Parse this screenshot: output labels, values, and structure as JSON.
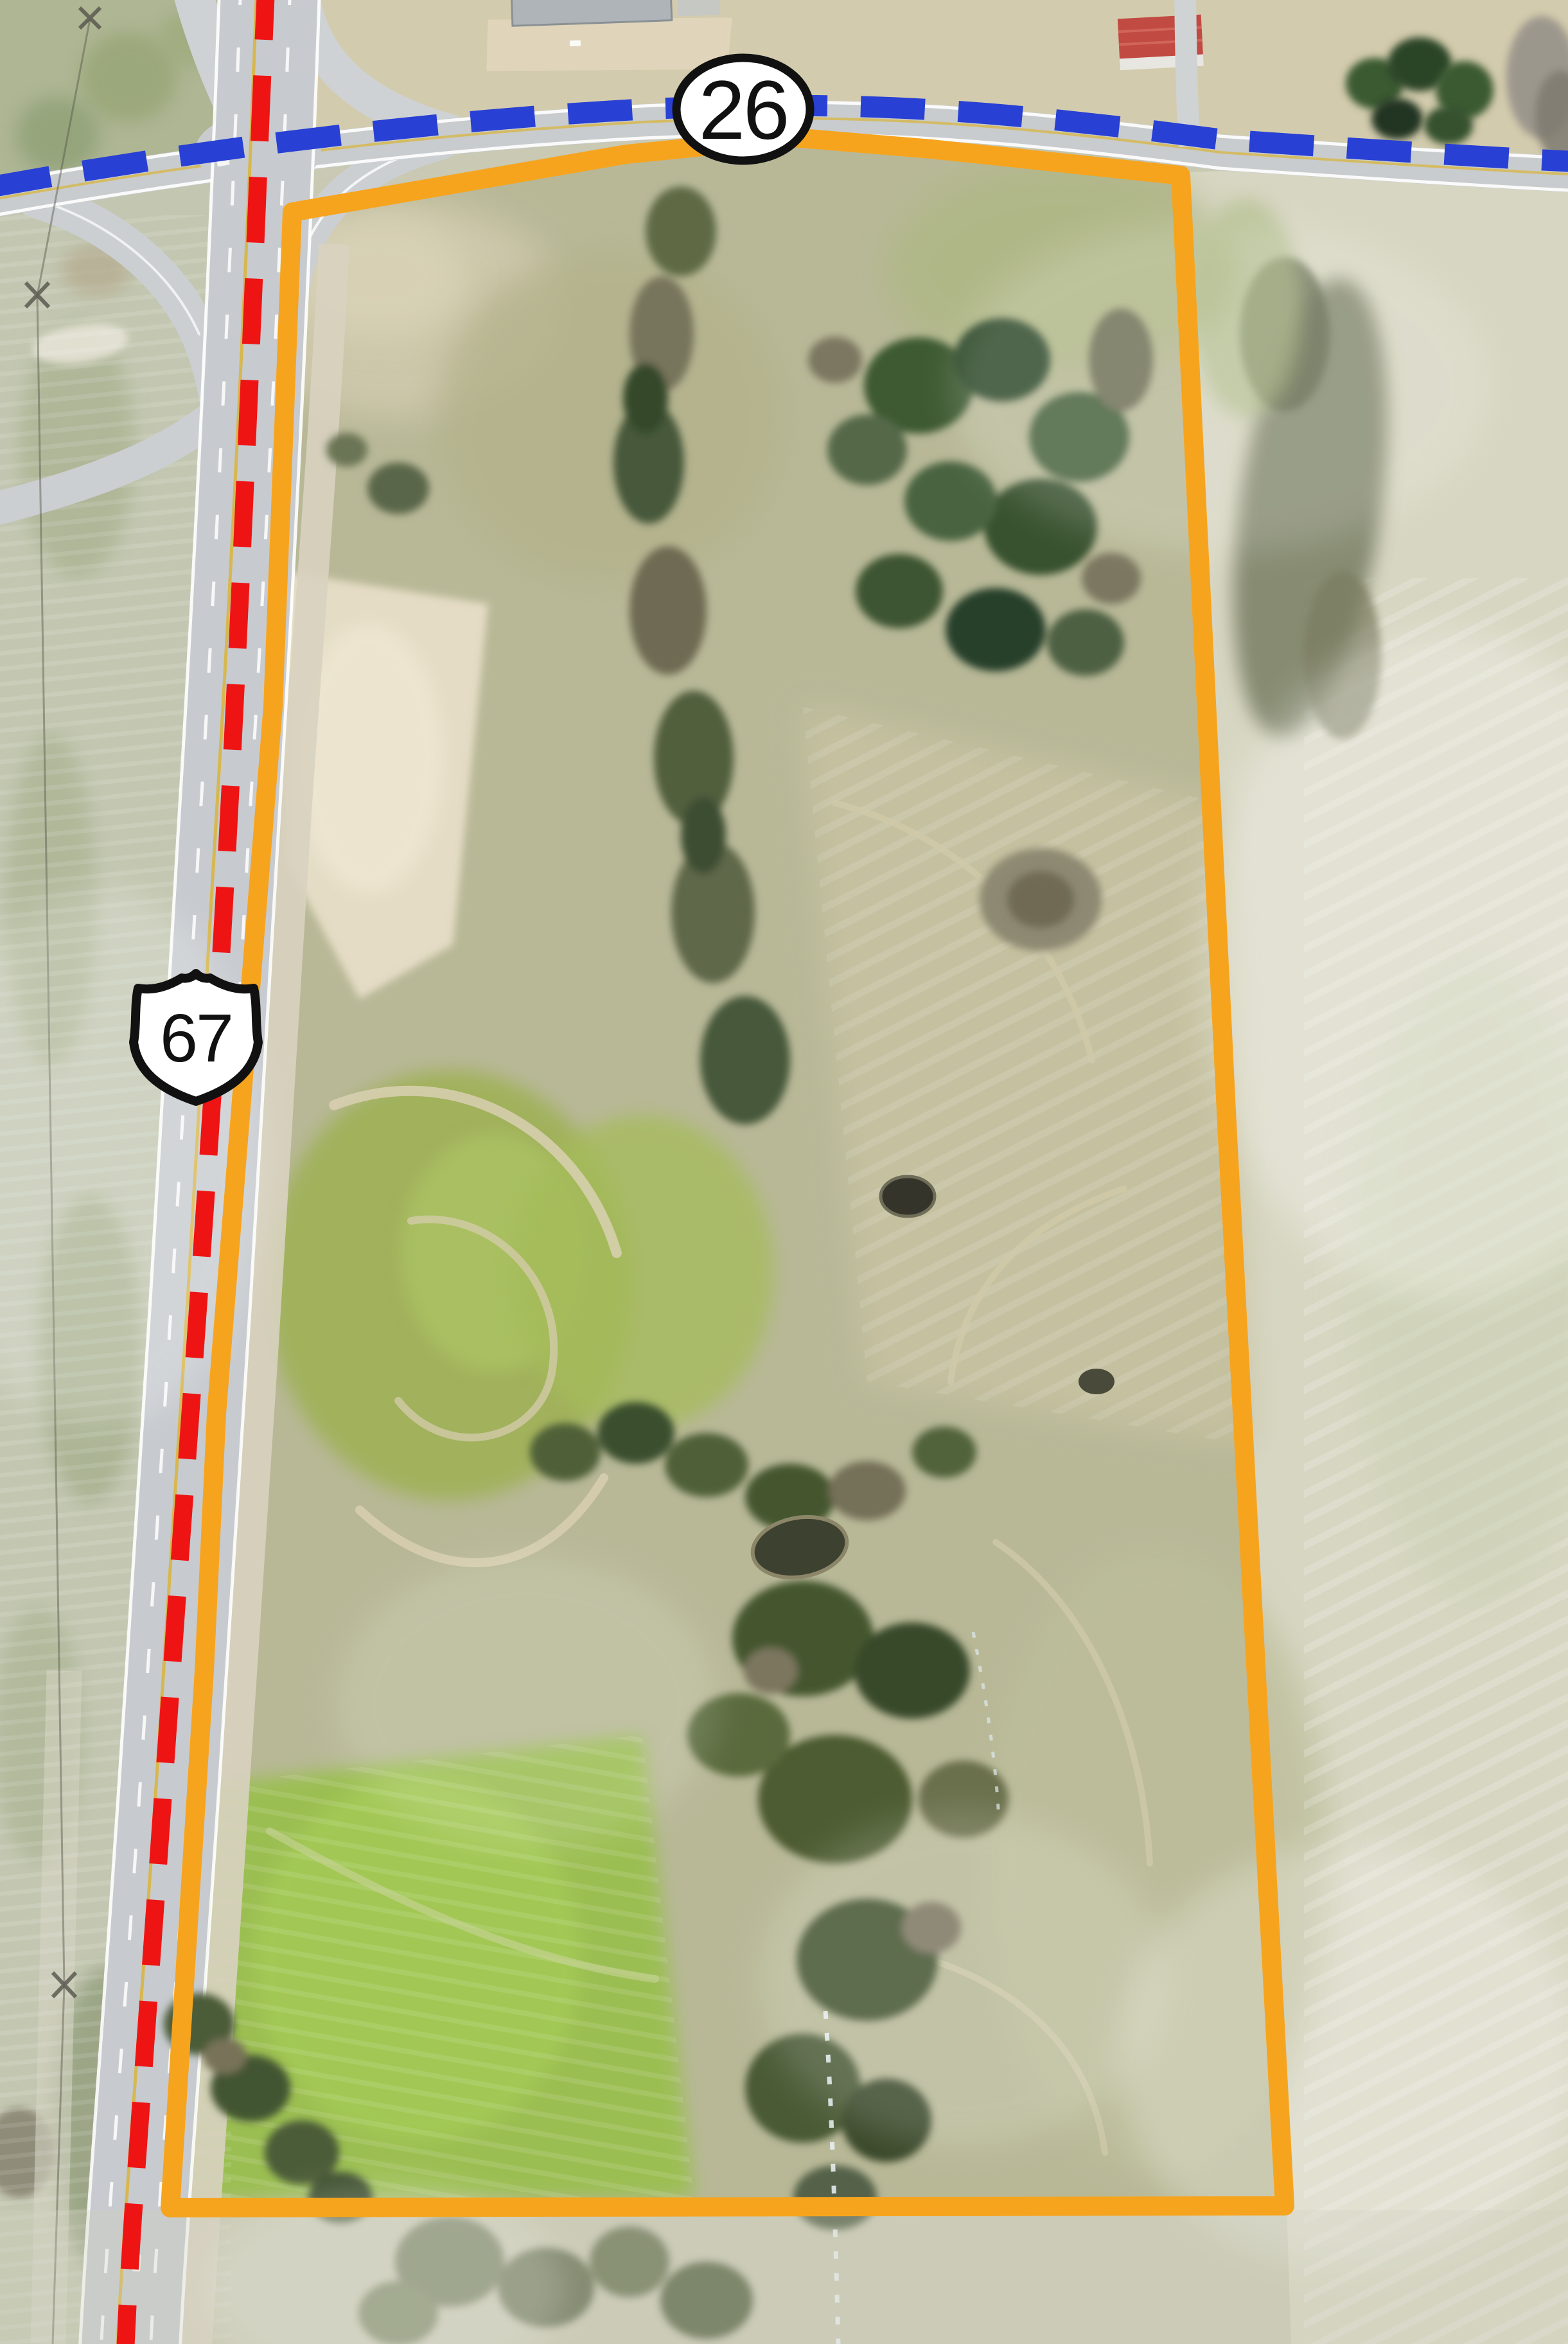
{
  "map": {
    "type": "aerial-property-parcel-map",
    "parcel": {
      "boundary_color": "#F6A41E"
    },
    "routes": {
      "route26": {
        "label": "26",
        "marker_shape": "oval",
        "dash_color": "#2840D4"
      },
      "us67": {
        "label": "67",
        "marker_shape": "us-route-shield",
        "dash_color": "#EE1414"
      }
    },
    "colors": {
      "road_gray": "#C9CED2",
      "field_pale": "#D6D5C2",
      "pasture_green": "#9DBC52",
      "trees_dark": "#3D5631",
      "bare_dirt": "#E7DEC8"
    }
  }
}
